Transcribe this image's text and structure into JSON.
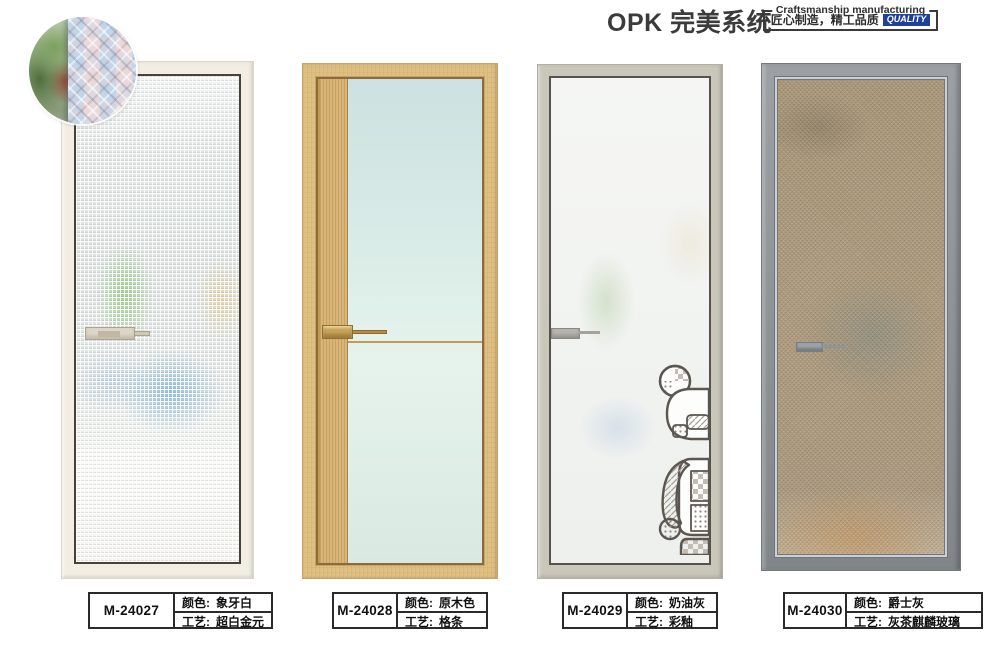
{
  "header": {
    "brand": "OPK 完美系统",
    "tagline_en": "Craftsmanship manufacturing",
    "tagline_cn": "匠心制造，精工品质",
    "quality_badge": "QUALITY",
    "quality_badge_color": "#20419a"
  },
  "field_labels": {
    "color": "颜色:",
    "craft": "工艺:"
  },
  "products": [
    {
      "model": "M-24027",
      "color": "象牙白",
      "craft": "超白金元",
      "frame_color": "#f2eee3"
    },
    {
      "model": "M-24028",
      "color": "原木色",
      "craft": "格条",
      "frame_color": "#dfc083"
    },
    {
      "model": "M-24029",
      "color": "奶油灰",
      "craft": "彩釉",
      "frame_color": "#c9c6ba"
    },
    {
      "model": "M-24030",
      "color": "爵士灰",
      "craft": "灰茶麒麟玻璃",
      "frame_color": "#8c9196"
    }
  ]
}
